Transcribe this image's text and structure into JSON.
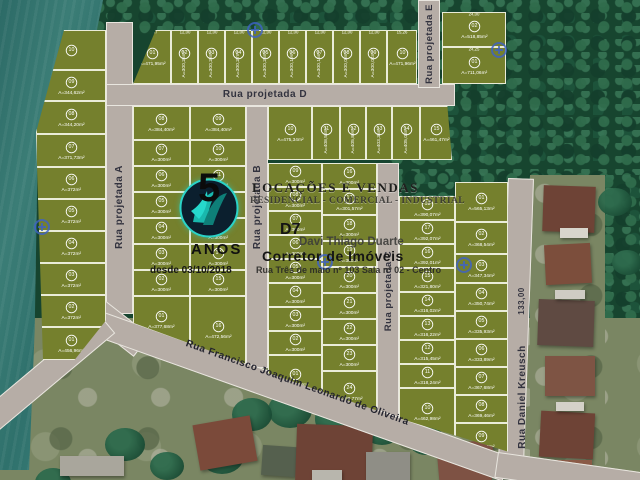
{
  "colors": {
    "lot": "#75802d",
    "street": "#b6ada6",
    "water": "#35756f",
    "forest": "#17452f",
    "marker_blue": "#3d62c8",
    "logo_teal": "#2bd3c7",
    "logo_navy": "#0b1f2e"
  },
  "streets": {
    "a": "Rua projetada A",
    "b": "Rua projetada B",
    "c": "Rua projetada C",
    "d": "Rua projetada D",
    "e": "Rua projetada E",
    "francisco": "Rua Francisco Joaquim Leonardo de Oliveira",
    "daniel": "Rua Daniel Kreusch",
    "dim133": "133,00"
  },
  "watermark": {
    "big_number": "5",
    "anos": "ANOS",
    "desde": "desde 03/10/2018",
    "line1": "LOCAÇÕES E VENDAS",
    "line2": "RESIDENCIAL - COMERCIAL - INDUSTRIAL",
    "brand": "D7",
    "agent": "Davi Thiago Duarte",
    "role": "Corretor de Imóveis",
    "address": "Rua Três de maio nº 103 Sala nº 02 - Centro"
  },
  "blocks": {
    "west": {
      "lots": [
        {
          "n": "10",
          "a": ""
        },
        {
          "n": "09",
          "a": "A=344,62m²"
        },
        {
          "n": "08",
          "a": "A=344,20m²"
        },
        {
          "n": "07",
          "a": "A=371,73m²"
        },
        {
          "n": "06",
          "a": "A=372m²"
        },
        {
          "n": "05",
          "a": "A=372m²"
        },
        {
          "n": "04",
          "a": "A=372m²"
        },
        {
          "n": "03",
          "a": "A=372m²"
        },
        {
          "n": "02",
          "a": "A=372m²"
        },
        {
          "n": "01",
          "a": "A=456,96m²"
        }
      ]
    },
    "top": {
      "lots": [
        {
          "n": "01",
          "a": "A=471,95m²",
          "d": "13,87"
        },
        {
          "n": "02",
          "a": "A=300,26m²",
          "d": "12,00"
        },
        {
          "n": "03",
          "a": "A=300,28m²",
          "d": "12,00"
        },
        {
          "n": "04",
          "a": "A=300,27m²",
          "d": "12,00"
        },
        {
          "n": "05",
          "a": "A=300,25m²",
          "d": "12,00"
        },
        {
          "n": "06",
          "a": "A=300,19m²",
          "d": "12,00"
        },
        {
          "n": "07",
          "a": "A=300,15m²",
          "d": "12,00"
        },
        {
          "n": "08",
          "a": "A=300,08m²",
          "d": "12,00"
        },
        {
          "n": "09",
          "a": "A=300,04m²",
          "d": "12,00"
        },
        {
          "n": "10",
          "a": "A=471,96m²",
          "d": "15,26"
        }
      ]
    },
    "ne": {
      "lots": [
        {
          "n": "02",
          "a": "A=518,85m²",
          "d": "24,00"
        },
        {
          "n": "01",
          "a": "A=711,06m²",
          "d": "24,25"
        }
      ]
    },
    "ab": {
      "left": [
        {
          "n": "08",
          "a": "A=384,40m²"
        },
        {
          "n": "07",
          "a": "A=300m²"
        },
        {
          "n": "06",
          "a": "A=300m²"
        },
        {
          "n": "05",
          "a": "A=300m²"
        },
        {
          "n": "04",
          "a": "A=300m²"
        },
        {
          "n": "03",
          "a": "A=300m²"
        },
        {
          "n": "02",
          "a": "A=300m²"
        },
        {
          "n": "01",
          "a": "A=377,68m²"
        }
      ],
      "right": [
        {
          "n": "09",
          "a": "A=384,40m²"
        },
        {
          "n": "10",
          "a": "A=300m²"
        },
        {
          "n": "11",
          "a": "A=300m²"
        },
        {
          "n": "12",
          "a": "A=300m²"
        },
        {
          "n": "13",
          "a": "A=300m²"
        },
        {
          "n": "14",
          "a": "A=300m²"
        },
        {
          "n": "15",
          "a": "A=300m²"
        },
        {
          "n": "16",
          "a": "A=472,56m²"
        }
      ]
    },
    "bc": {
      "top": [
        {
          "n": "10",
          "a": "A=475,34m²"
        },
        {
          "n": "11",
          "a": "A=408,53m²"
        },
        {
          "n": "12",
          "a": "A=405,89m²"
        },
        {
          "n": "13",
          "a": "A=403,36m²"
        },
        {
          "n": "14",
          "a": "A=405,03m²"
        },
        {
          "n": "15",
          "a": "A=461,47m²"
        }
      ],
      "left": [
        {
          "n": "09",
          "a": "A=300m²"
        },
        {
          "n": "08",
          "a": "A=300m²"
        },
        {
          "n": "07",
          "a": "A=300m²"
        },
        {
          "n": "06",
          "a": "A=300m²"
        },
        {
          "n": "05",
          "a": "A=300m²"
        },
        {
          "n": "04",
          "a": "A=300m²"
        },
        {
          "n": "03",
          "a": "A=300m²"
        },
        {
          "n": "02",
          "a": "A=300m²"
        },
        {
          "n": "01",
          "a": "A=391,58m²"
        }
      ],
      "right": [
        {
          "n": "16",
          "a": "A=300m²"
        },
        {
          "n": "17",
          "a": "A=301,57m²"
        },
        {
          "n": "18",
          "a": "A=300m²"
        },
        {
          "n": "19",
          "a": "A=300m²"
        },
        {
          "n": "20",
          "a": "A=300m²"
        },
        {
          "n": "21",
          "a": "A=300m²"
        },
        {
          "n": "22",
          "a": "A=300m²"
        },
        {
          "n": "23",
          "a": "A=300m²"
        },
        {
          "n": "24",
          "a": "A=388,77m²"
        }
      ]
    },
    "east": {
      "left": [
        {
          "n": "18",
          "a": "A=390,07m²"
        },
        {
          "n": "17",
          "a": "A=392,07m²"
        },
        {
          "n": "16",
          "a": "A=392,01m²"
        },
        {
          "n": "15",
          "a": "A=321,80m²"
        },
        {
          "n": "14",
          "a": "A=316,02m²"
        },
        {
          "n": "13",
          "a": "A=316,22m²"
        },
        {
          "n": "12",
          "a": "A=315,45m²"
        },
        {
          "n": "11",
          "a": "A=318,24m²"
        },
        {
          "n": "10",
          "a": "A=462,98m²"
        }
      ],
      "right": [
        {
          "n": "01",
          "a": "A=565,13m²"
        },
        {
          "n": "02",
          "a": "A=368,54m²"
        },
        {
          "n": "03",
          "a": "A=347,34m²"
        },
        {
          "n": "04",
          "a": "A=350,74m²"
        },
        {
          "n": "05",
          "a": "A=335,93m²"
        },
        {
          "n": "06",
          "a": "A=333,89m²"
        },
        {
          "n": "07",
          "a": "A=367,68m²"
        },
        {
          "n": "08",
          "a": "A=369,46m²"
        },
        {
          "n": "09",
          "a": "A=314,90m²"
        }
      ]
    }
  },
  "markers": [
    [
      253,
      28
    ],
    [
      497,
      48
    ],
    [
      40,
      225
    ],
    [
      323,
      260
    ],
    [
      462,
      263
    ]
  ]
}
